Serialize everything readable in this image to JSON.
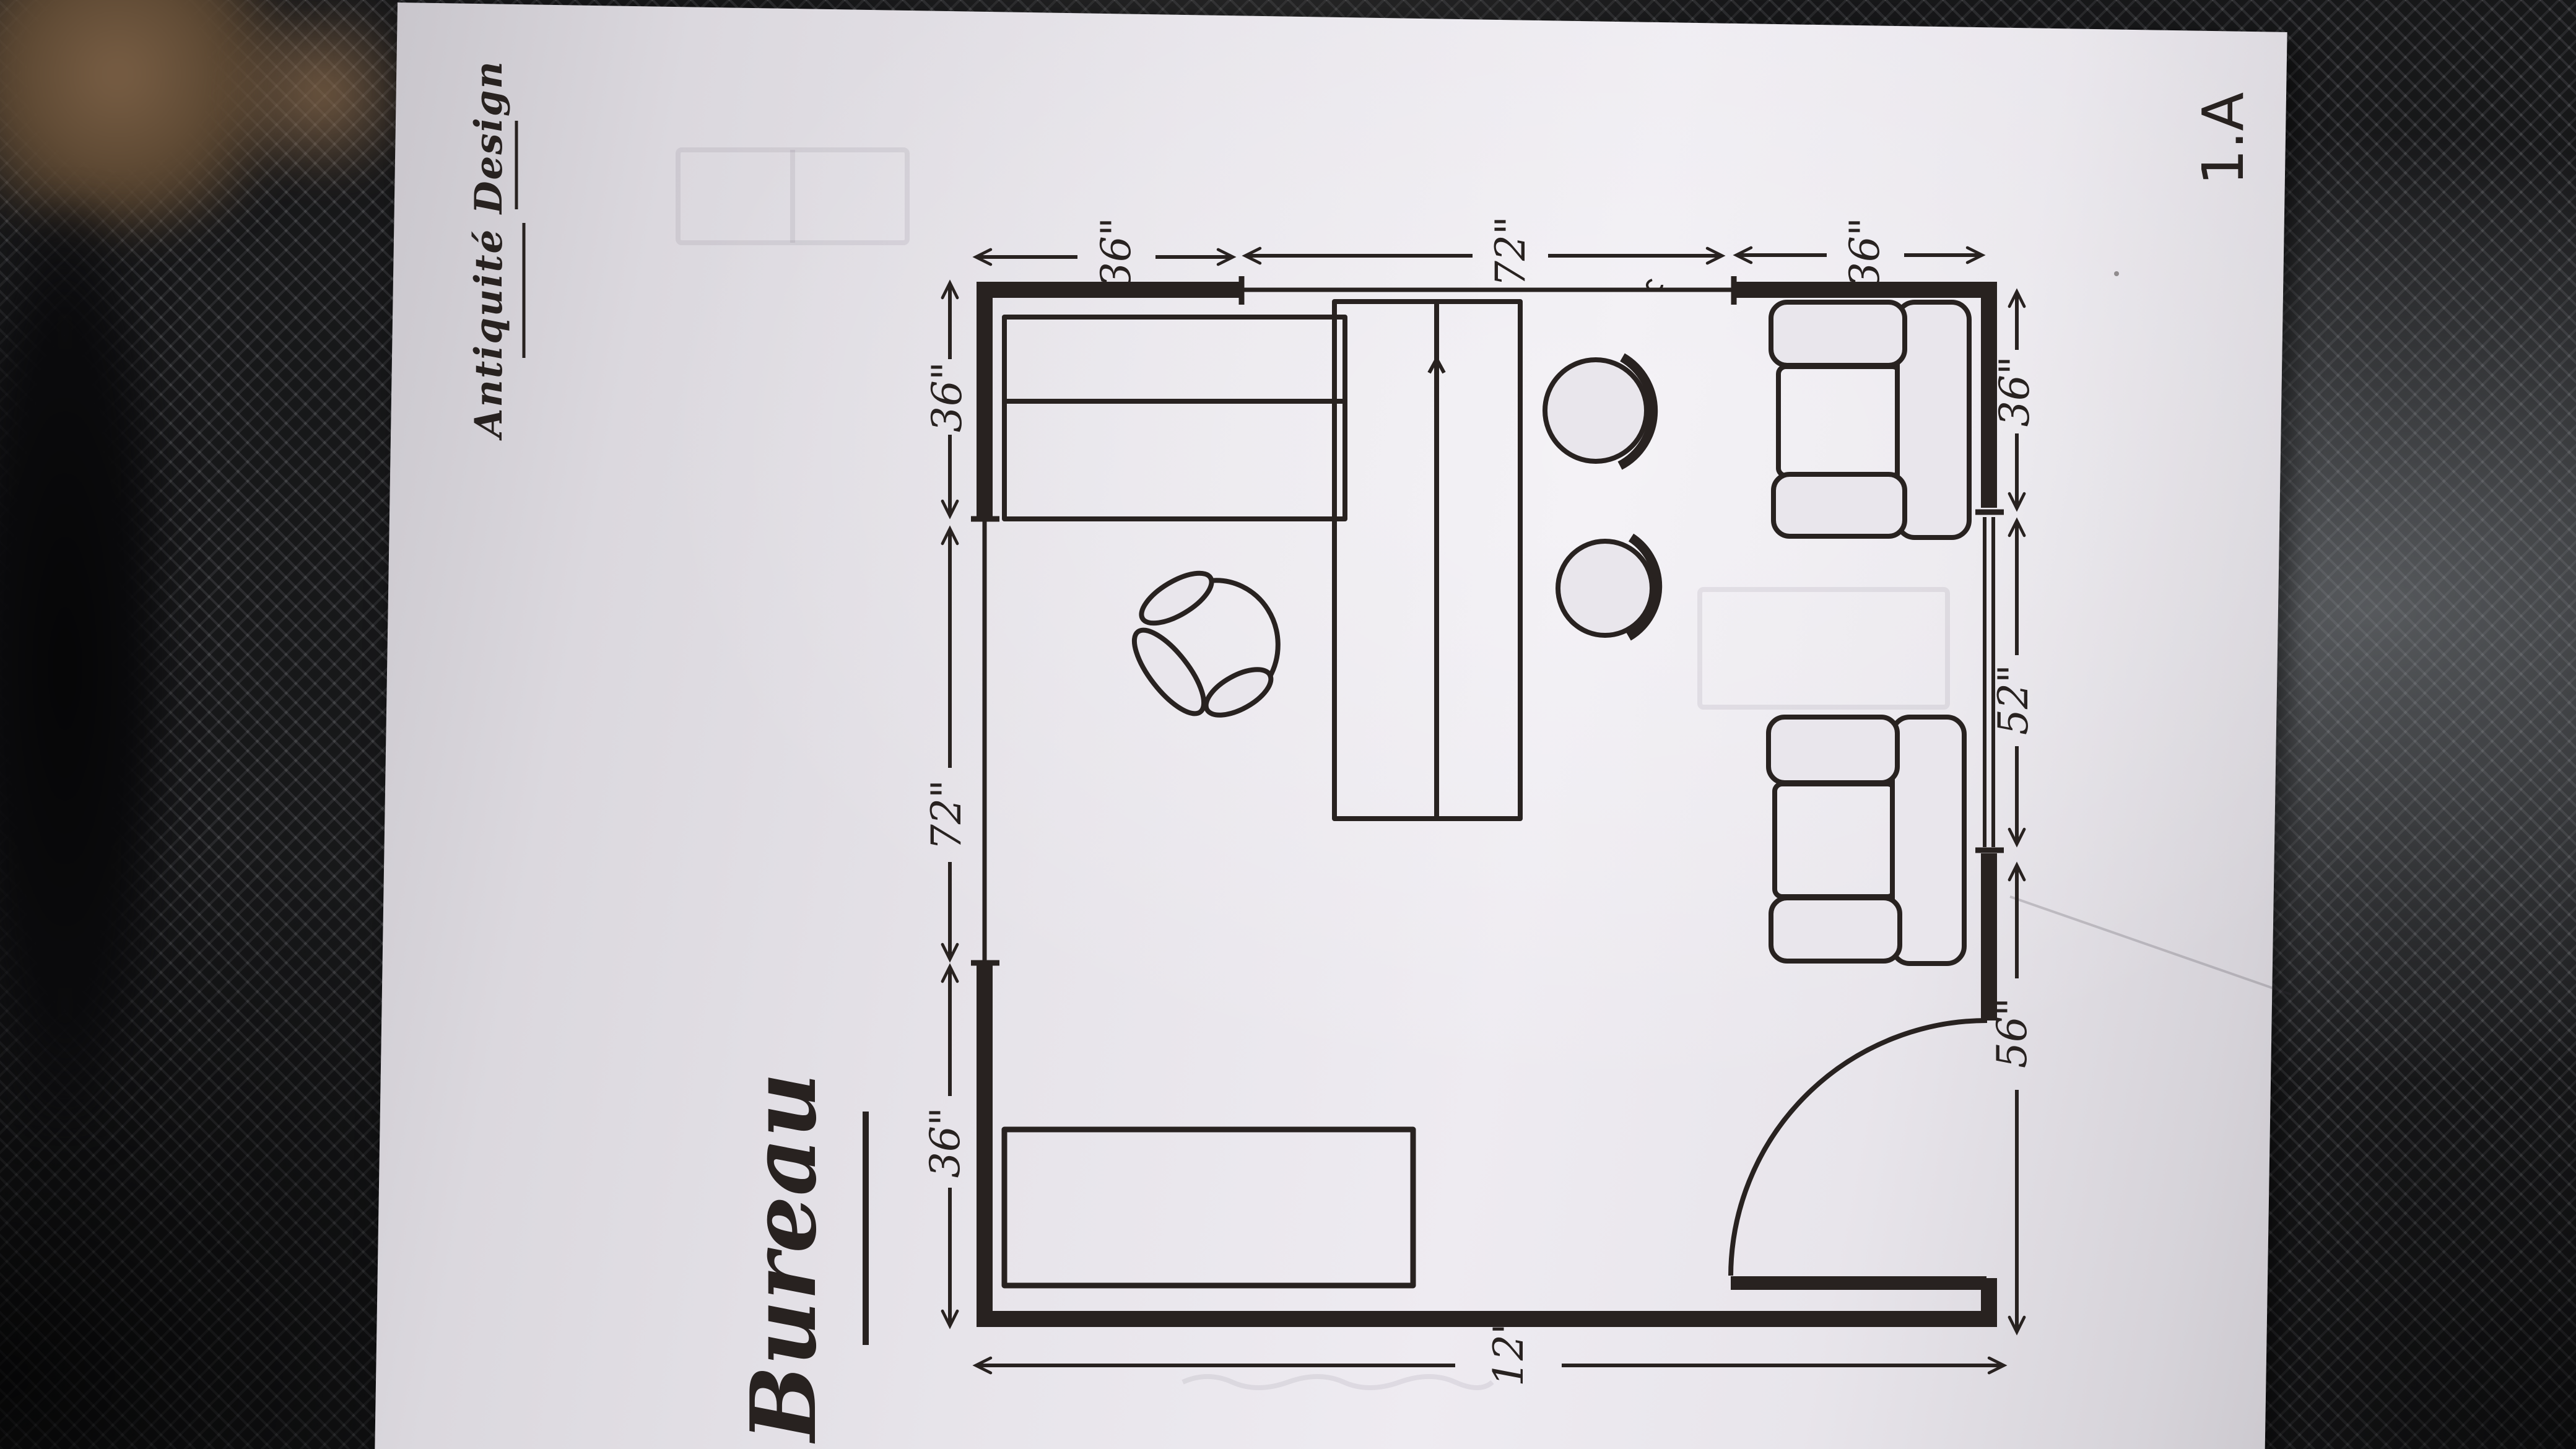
{
  "sheet": {
    "title": "Bureau",
    "brand": "Antiquité Design",
    "number": "1.A"
  },
  "dimensions": {
    "top": [
      "36\"",
      "72\"",
      "36\""
    ],
    "left": [
      "36\"",
      "72\"",
      "36\""
    ],
    "right": [
      "36\"",
      "52\"",
      "56\""
    ],
    "bottom": [
      "12\""
    ]
  },
  "colors": {
    "ink": "#282220",
    "paper": "#e9e6ec",
    "fabric": "#2c2d30",
    "leather_brown": "#7a5f45"
  }
}
